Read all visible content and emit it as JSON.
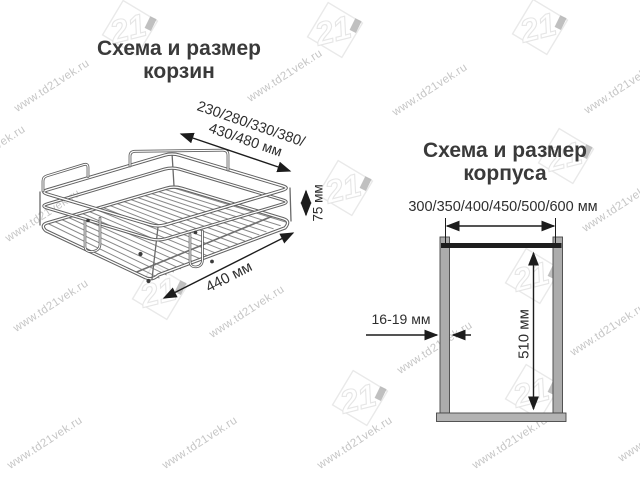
{
  "watermark": {
    "text": "www.td21vek.ru",
    "logo_text": "21"
  },
  "basket_section": {
    "title": "Схема и размер корзин",
    "width_label_lines": [
      "230/280/330/380/",
      "430/480 мм"
    ],
    "height_label": "75 мм",
    "depth_label": "440 мм"
  },
  "cabinet_section": {
    "title": "Схема и размер корпуса",
    "width_label": "300/350/400/450/500/600 мм",
    "height_label": "510 мм",
    "thickness_label": "16-19 мм"
  },
  "colors": {
    "text": "#333333",
    "dimension_line": "#1c1c1c",
    "wire": "#666666",
    "wall_fill": "#acacac",
    "wall_stroke": "#454545",
    "top_rail": "#1e1e1e",
    "watermark": "#c6c6c6",
    "logo_outline": "#e9e9e9"
  }
}
